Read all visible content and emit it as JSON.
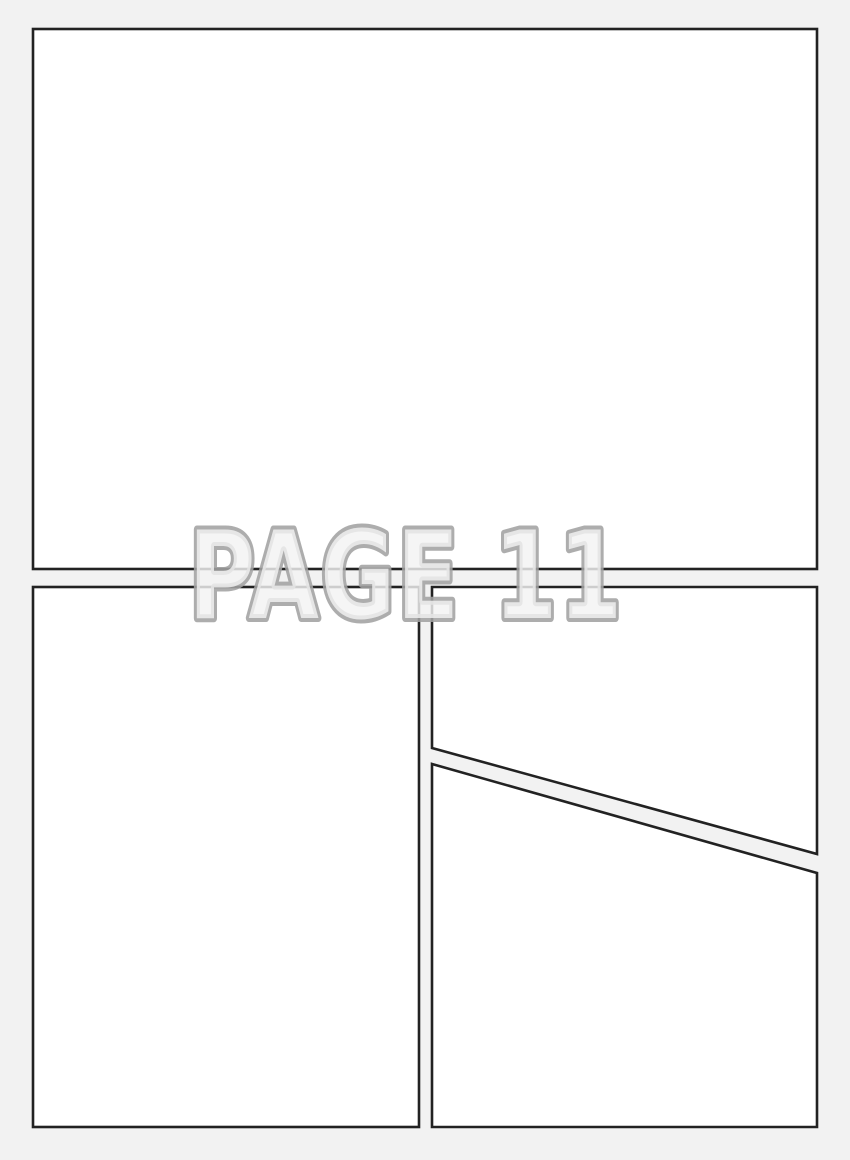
{
  "watermark": {
    "label": "PAGE 11"
  },
  "colors": {
    "page_bg": "#f2f2f2",
    "panel_fill": "#ffffff",
    "panel_border": "#222222",
    "watermark_fill": "#f3f3f3",
    "watermark_stroke": "#a2a2a2"
  },
  "panels": [
    {
      "id": "panel-1",
      "position": "top",
      "shape": "rectangle"
    },
    {
      "id": "panel-2",
      "position": "bottom-left",
      "shape": "rectangle"
    },
    {
      "id": "panel-3",
      "position": "bottom-right-upper",
      "shape": "polygon-diagonal-bottom"
    },
    {
      "id": "panel-4",
      "position": "bottom-right-lower",
      "shape": "polygon-diagonal-top"
    }
  ]
}
